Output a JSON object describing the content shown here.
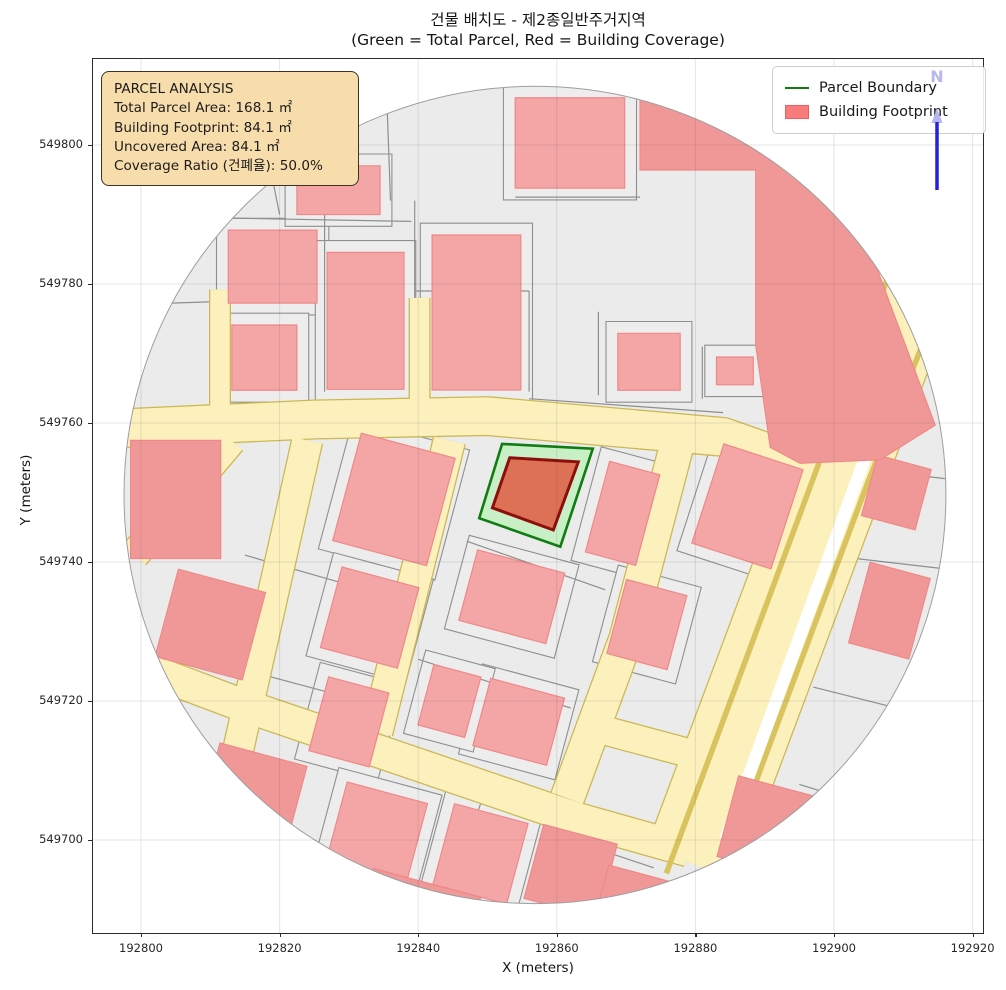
{
  "title": {
    "line1": "건물 배치도 - 제2종일반주거지역",
    "line2": "(Green = Total Parcel, Red = Building Coverage)"
  },
  "axes": {
    "xlabel": "X (meters)",
    "ylabel": "Y (meters)",
    "x_ticks": [
      192800,
      192820,
      192840,
      192860,
      192880,
      192900,
      192920
    ],
    "x_tick_labels": [
      "192800",
      "192820",
      "192840",
      "192860",
      "192880",
      "192900",
      "192920"
    ],
    "y_ticks": [
      549800,
      549780,
      549760,
      549740,
      549720,
      549700
    ],
    "y_tick_labels": [
      "549800",
      "549780",
      "549760",
      "549740",
      "549720",
      "549700"
    ],
    "x_range": [
      192793.1,
      192921.5
    ],
    "y_range": [
      549686.6,
      549812.4
    ],
    "grid": true
  },
  "legend": {
    "items": [
      {
        "label": "Parcel Boundary",
        "type": "line",
        "color": "#0f7d12"
      },
      {
        "label": "Building Footprint",
        "type": "patch",
        "color": "#f87c7c",
        "edge": "#ee5c5c"
      }
    ]
  },
  "info_box": {
    "title": "PARCEL ANALYSIS",
    "lines": [
      "Total Parcel Area: 168.1 ㎡",
      "Building Footprint: 84.1 ㎡",
      "Uncovered Area: 84.1 ㎡",
      "Coverage Ratio (건폐율): 50.0%"
    ]
  },
  "north_arrow": {
    "label": "N"
  },
  "chart_data": {
    "type": "map",
    "title": "건물 배치도 - 제2종일반주거지역",
    "key_metrics": {
      "total_parcel_area_m2": 168.1,
      "building_footprint_m2": 84.1,
      "uncovered_area_m2": 84.1,
      "coverage_ratio_pct": 50.0,
      "zoning": "제2종일반주거지역"
    },
    "colors": {
      "base": "#ebebeb",
      "base_stroke": "#9e9e9e",
      "parcel_fill": "#ededed",
      "parcel_stroke": "#8f8f8f",
      "building_fill": "#f4a6a6",
      "building_edge": "#ef8888",
      "building_deep": "#f09898",
      "road_fill": "#fcf1bd",
      "road_edge": "#ccb955",
      "lane_line": "#d9c35f",
      "median": "#ffffff",
      "parcel_highlight_fill": "#c9efc6",
      "parcel_highlight_edge": "#0f7d12",
      "building_highlight_fill": "#dd7156",
      "building_highlight_edge": "#8c0f0b",
      "grid": "rgba(60,60,60,0.13)",
      "north_line": "#2323dd",
      "north_text": "#b6b6f0"
    },
    "calib": {
      "x0": 192800,
      "y0": 549800,
      "kx": 6.93,
      "ky": 6.95,
      "ox": 48,
      "oy": 86
    },
    "boundary": {
      "cx": 192856.85,
      "cy": 549749.65,
      "rx": 59.3,
      "ry": 58.8
    },
    "roads": [
      {
        "name": "ew-road",
        "pts": [
          [
            192792,
            549759
          ],
          [
            192825,
            549760.5
          ],
          [
            192850,
            549761
          ],
          [
            192884,
            549758
          ],
          [
            192894,
            549754.5
          ]
        ],
        "w": 5.4
      },
      {
        "name": "sw-wedge",
        "pts": [
          [
            192813,
            549757.5
          ],
          [
            192799,
            549741
          ]
        ],
        "w": 4.2
      },
      {
        "name": "alley-north-1",
        "pts": [
          [
            192811.4,
            549762.5
          ],
          [
            192811.4,
            549779.2
          ]
        ],
        "w": 2.8
      },
      {
        "name": "alley-north-2",
        "pts": [
          [
            192840.2,
            549761
          ],
          [
            192840.2,
            549778
          ]
        ],
        "w": 2.8
      },
      {
        "name": "street-s1",
        "pts": [
          [
            192824,
            549757.5
          ],
          [
            192812,
            549704
          ]
        ],
        "w": 4.3
      },
      {
        "name": "street-s2",
        "pts": [
          [
            192844.5,
            549757.5
          ],
          [
            192834,
            549715.5
          ]
        ],
        "w": 4.5
      },
      {
        "name": "street-s3",
        "pts": [
          [
            192877.5,
            549757.5
          ],
          [
            192870,
            549729
          ],
          [
            192861.5,
            549706
          ]
        ],
        "w": 4.8
      },
      {
        "name": "cross-street",
        "pts": [
          [
            192801,
            549724.5
          ],
          [
            192813,
            549720
          ],
          [
            192863,
            549703
          ],
          [
            192879,
            549698.5
          ]
        ],
        "w": 4.6
      },
      {
        "name": "connector",
        "pts": [
          [
            192866,
            549716
          ],
          [
            192881,
            549712
          ]
        ],
        "w": 4
      },
      {
        "name": "boulevard",
        "pts": [
          [
            192918,
            549799
          ],
          [
            192900.5,
            549752.6
          ],
          [
            192879.5,
            549696.6
          ]
        ],
        "w": 13.8
      }
    ],
    "road_details": [
      {
        "name": "lane-line-left",
        "pts": [
          [
            192913,
            549795
          ],
          [
            192896.7,
            549751.2
          ],
          [
            192875.8,
            549695.2
          ]
        ],
        "w": 0.8,
        "color": "#d9c35f"
      },
      {
        "name": "lane-line-right",
        "pts": [
          [
            192921,
            549792
          ],
          [
            192904.7,
            549751
          ],
          [
            192883.7,
            549695
          ]
        ],
        "w": 0.8,
        "color": "#d9c35f"
      },
      {
        "name": "median",
        "pts": [
          [
            192904.5,
            549755
          ],
          [
            192884.3,
            549700
          ]
        ],
        "w": 1.8,
        "color": "#ffffff"
      }
    ],
    "buildings": [
      {
        "cx": 192819,
        "cy": 549782.5,
        "w": 12.8,
        "h": 10.5,
        "a": 0
      },
      {
        "cx": 192817.8,
        "cy": 549769.4,
        "w": 9.4,
        "h": 9.4,
        "a": 0
      },
      {
        "cx": 192832.4,
        "cy": 549774.7,
        "w": 11.1,
        "h": 19.7,
        "a": 0
      },
      {
        "cx": 192828.5,
        "cy": 549793.5,
        "w": 12,
        "h": 7,
        "a": 0
      },
      {
        "cx": 192848.4,
        "cy": 549775.9,
        "w": 12.8,
        "h": 22.3,
        "a": 0
      },
      {
        "cx": 192873.3,
        "cy": 549768.8,
        "w": 9,
        "h": 8.2,
        "a": 0
      },
      {
        "cx": 192885.7,
        "cy": 549767.5,
        "w": 5.3,
        "h": 4,
        "a": 0
      },
      {
        "cx": 192861.9,
        "cy": 549800.3,
        "w": 15.8,
        "h": 13,
        "a": 0
      },
      {
        "cx": 192809,
        "cy": 549799,
        "w": 12,
        "h": 10,
        "a": -25,
        "rim": true
      },
      {
        "cx": 192836.5,
        "cy": 549749,
        "w": 14,
        "h": 16,
        "a": -15
      },
      {
        "cx": 192833,
        "cy": 549732,
        "w": 11.5,
        "h": 12,
        "a": -15
      },
      {
        "cx": 192830,
        "cy": 549717,
        "w": 9,
        "h": 11,
        "a": -15
      },
      {
        "cx": 192853.5,
        "cy": 549735,
        "w": 13,
        "h": 10.5,
        "a": -15
      },
      {
        "cx": 192854.5,
        "cy": 549717,
        "w": 11,
        "h": 10,
        "a": -15
      },
      {
        "cx": 192844.5,
        "cy": 549720,
        "w": 7,
        "h": 9,
        "a": -15
      },
      {
        "cx": 192869.5,
        "cy": 549747,
        "w": 7.5,
        "h": 13.5,
        "a": -15
      },
      {
        "cx": 192887.5,
        "cy": 549748,
        "w": 12,
        "h": 15,
        "a": -18
      },
      {
        "cx": 192873,
        "cy": 549731,
        "w": 9,
        "h": 11,
        "a": -15
      },
      {
        "cx": 192805,
        "cy": 549749,
        "w": 13,
        "h": 17,
        "a": 0,
        "rim": true
      },
      {
        "cx": 192810,
        "cy": 549731,
        "w": 13,
        "h": 13,
        "a": -15,
        "rim": true
      },
      {
        "cx": 192816,
        "cy": 549706,
        "w": 13,
        "h": 13,
        "a": -15,
        "rim": true
      },
      {
        "cx": 192834,
        "cy": 549701,
        "w": 12,
        "h": 12,
        "a": -15
      },
      {
        "cx": 192849,
        "cy": 549698,
        "w": 11,
        "h": 12,
        "a": -15
      },
      {
        "cx": 192862,
        "cy": 549695.5,
        "w": 11,
        "h": 11,
        "a": -15,
        "rim": true
      },
      {
        "cx": 192909,
        "cy": 549750,
        "w": 8,
        "h": 9,
        "a": -15,
        "rim": true
      },
      {
        "cx": 192908,
        "cy": 549733,
        "w": 9,
        "h": 12,
        "a": -15,
        "rim": true
      },
      {
        "cx": 192890,
        "cy": 549702,
        "w": 11,
        "h": 12,
        "a": -15,
        "rim": true
      },
      {
        "cx": 192840,
        "cy": 549689,
        "w": 16,
        "h": 10,
        "a": -15,
        "rim": true
      },
      {
        "cx": 192872,
        "cy": 549690,
        "w": 12,
        "h": 10,
        "a": -15,
        "rim": true
      }
    ],
    "building_polygons": [
      {
        "name": "large-northeast-building",
        "pts": [
          [
            192872.0,
            549807.2
          ],
          [
            192889.3,
            549804.7
          ],
          [
            192905.2,
            549784.9
          ],
          [
            192914.6,
            549759.7
          ],
          [
            192906.6,
            549754.7
          ],
          [
            192895.1,
            549754.2
          ],
          [
            192890.8,
            549756.5
          ],
          [
            192888.7,
            549771.2
          ],
          [
            192888.7,
            549796.4
          ],
          [
            192872.0,
            549796.4
          ]
        ]
      }
    ],
    "parcel_lines": [
      [
        [
          192811.5,
          549764
        ],
        [
          192811.5,
          549779
        ]
      ],
      [
        [
          192797,
          549777
        ],
        [
          192812,
          549777.5
        ]
      ],
      [
        [
          192826.5,
          549764.5
        ],
        [
          192826.5,
          549790
        ]
      ],
      [
        [
          192812,
          549789.5
        ],
        [
          192839,
          549789
        ]
      ],
      [
        [
          192839.5,
          549763
        ],
        [
          192839.5,
          549792
        ]
      ],
      [
        [
          192856,
          549764.5
        ],
        [
          192856,
          549779
        ]
      ],
      [
        [
          192839.5,
          549779
        ],
        [
          192856,
          549779
        ]
      ],
      [
        [
          192854,
          549792.5
        ],
        [
          192872,
          549792.5
        ]
      ],
      [
        [
          192820,
          549790
        ],
        [
          192817,
          549805
        ]
      ],
      [
        [
          192836,
          549792
        ],
        [
          192835.5,
          549806
        ]
      ],
      [
        [
          192856,
          549763.5
        ],
        [
          192884,
          549761.5
        ]
      ],
      [
        [
          192866,
          549764
        ],
        [
          192866,
          549776
        ]
      ],
      [
        [
          192881,
          549763.5
        ],
        [
          192881,
          549771
        ]
      ],
      [
        [
          192847,
          549743
        ],
        [
          192867,
          549736
        ]
      ],
      [
        [
          192840,
          549726
        ],
        [
          192862,
          549719
        ]
      ],
      [
        [
          192815,
          549741
        ],
        [
          192829,
          549737
        ]
      ],
      [
        [
          192813,
          549725
        ],
        [
          192828,
          549721
        ]
      ],
      [
        [
          192850,
          549708
        ],
        [
          192845,
          549694
        ]
      ],
      [
        [
          192859,
          549701
        ],
        [
          192874,
          549696
        ]
      ],
      [
        [
          192899,
          549754
        ],
        [
          192916,
          549752
        ]
      ],
      [
        [
          192899,
          549741
        ],
        [
          192916,
          549739
        ]
      ],
      [
        [
          192897,
          549722
        ],
        [
          192913,
          549718
        ]
      ],
      [
        [
          192895,
          549708
        ],
        [
          192908,
          549704
        ]
      ]
    ],
    "highlight_parcel": {
      "name": "target-parcel",
      "pts": [
        [
          192852.1,
          549757.0
        ],
        [
          192865.2,
          549756.3
        ],
        [
          192860.5,
          549742.2
        ],
        [
          192848.8,
          549746.3
        ]
      ]
    },
    "highlight_building": {
      "name": "target-building",
      "pts": [
        [
          192853.2,
          549755.0
        ],
        [
          192863.1,
          549754.4
        ],
        [
          192859.5,
          549744.6
        ],
        [
          192850.7,
          549747.8
        ]
      ]
    }
  }
}
